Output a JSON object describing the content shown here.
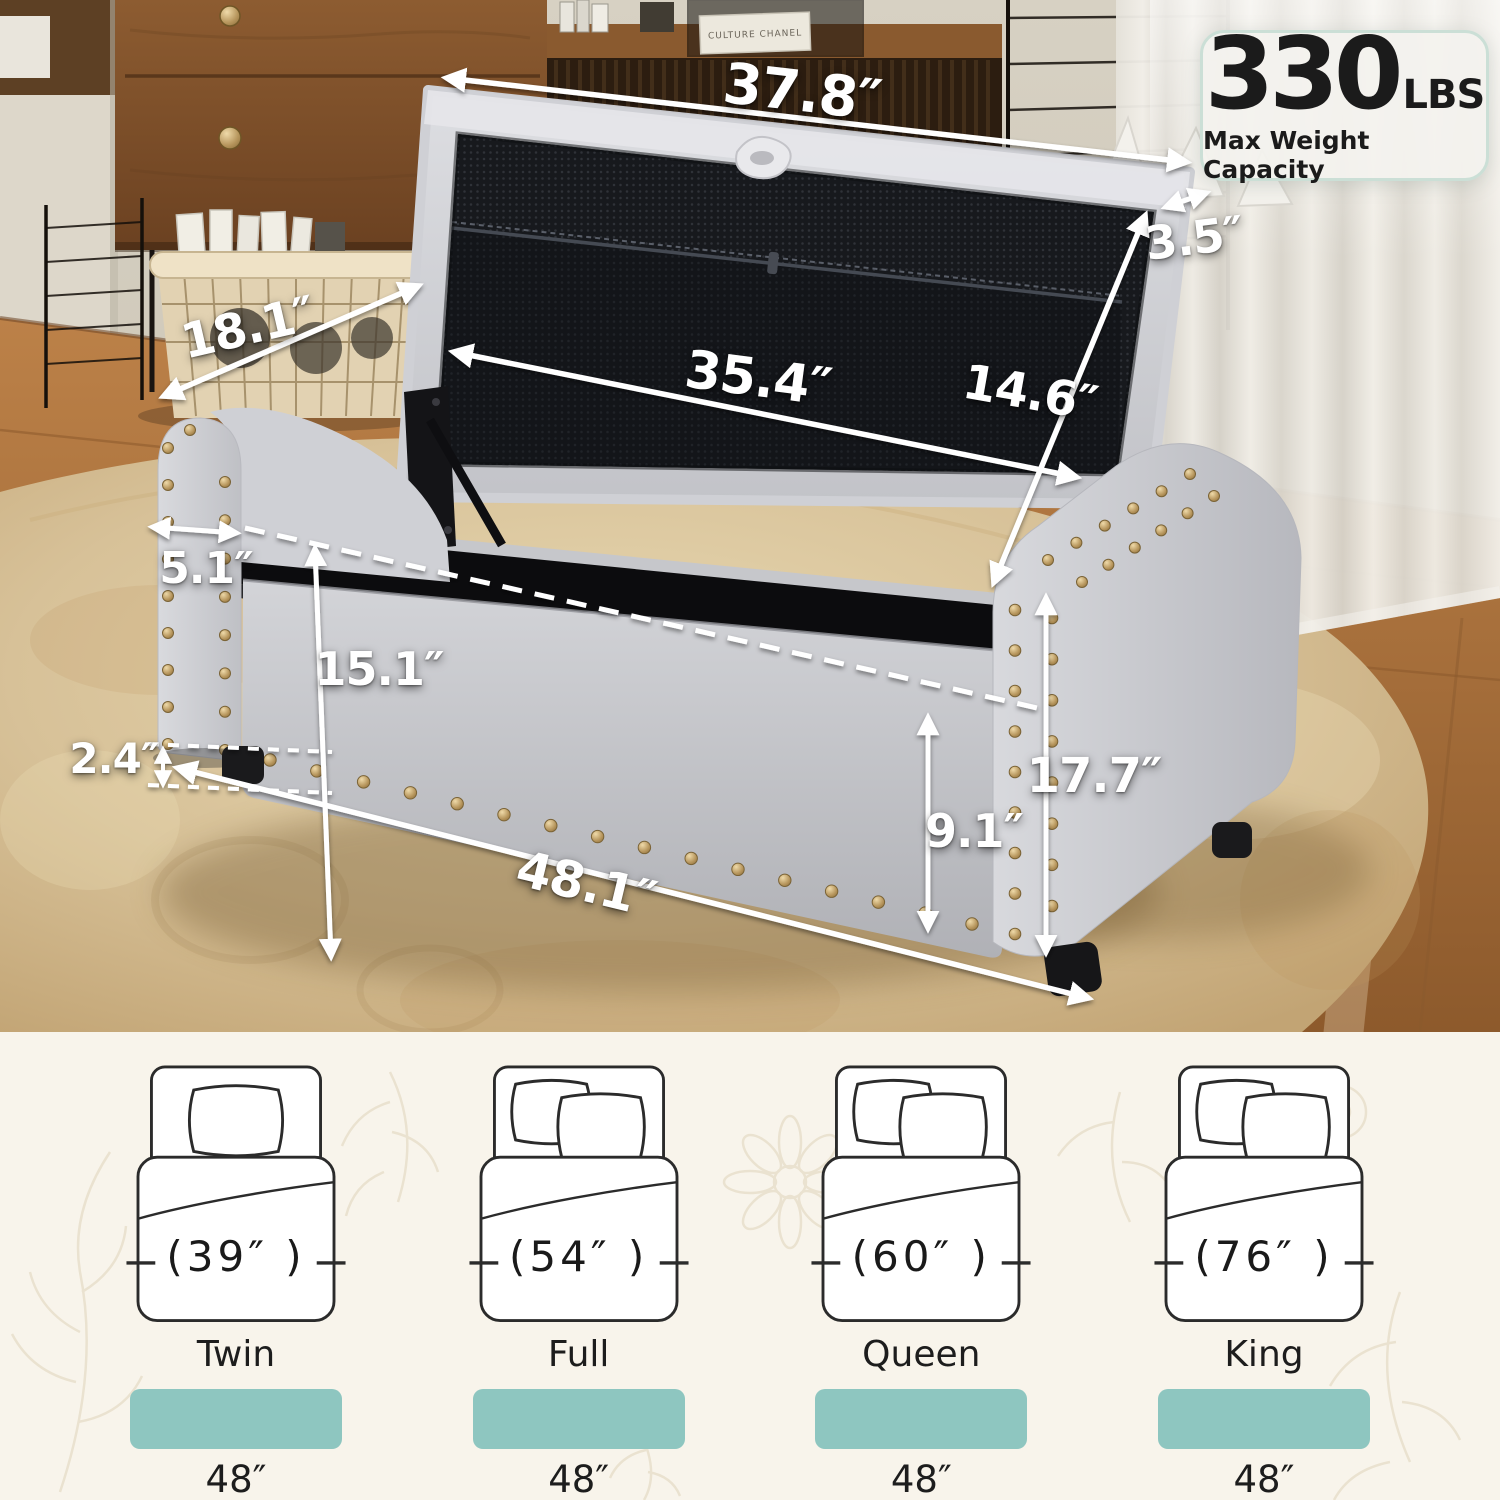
{
  "badge": {
    "value": "330",
    "unit": "LBS",
    "caption": "Max Weight Capacity"
  },
  "dimensions": {
    "lid_width": "37.8″",
    "lid_thickness": "3.5″",
    "depth": "18.1″",
    "inner_length": "35.4″",
    "lid_depth": "14.6″",
    "arm_width": "5.1″",
    "inner_height": "15.1″",
    "leg_height": "2.4″",
    "total_width": "48.1″",
    "front_height": "9.1″",
    "total_height": "17.7″"
  },
  "decor": {
    "book_spine": "CULTURE CHANEL"
  },
  "size_guide": {
    "items": [
      {
        "name": "Twin",
        "mattress_width": "(39″ )",
        "ottoman_width": "48″"
      },
      {
        "name": "Full",
        "mattress_width": "(54″ )",
        "ottoman_width": "48″"
      },
      {
        "name": "Queen",
        "mattress_width": "(60″ )",
        "ottoman_width": "48″"
      },
      {
        "name": "King",
        "mattress_width": "(76″ )",
        "ottoman_width": "48″"
      }
    ]
  },
  "colors": {
    "teal": "#8ec6c0",
    "badge_border": "#cbdfd6",
    "nailhead_gold": "#b9995f",
    "fabric_gray": "#c9cacd",
    "mesh_black": "#17191d",
    "rug_beige": "#d9c298",
    "wood_brown": "#7c4e2a",
    "dimension_text": "#ffffff"
  }
}
